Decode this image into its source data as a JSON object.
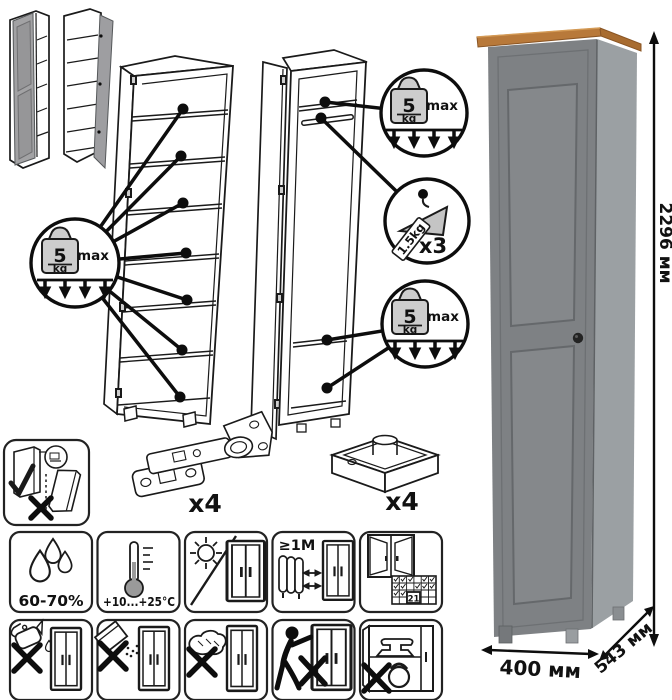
{
  "dimensions": {
    "height": "2296 мм",
    "width": "400 мм",
    "depth": "543 мм"
  },
  "load_limits": {
    "shelf": {
      "value": "5",
      "unit": "kg",
      "qualifier": "max"
    },
    "hanger": {
      "value": "1.5kg",
      "count": "x3"
    }
  },
  "hardware": {
    "hinge": {
      "count": "x4"
    },
    "foot": {
      "count": "x4"
    }
  },
  "care": {
    "humidity": "60-70%",
    "temperature": "+10...+25°C",
    "heater_distance": "≥1М",
    "ventilation_calendar_day": "21"
  },
  "colors": {
    "cabinet_front": "#7e8184",
    "cabinet_side": "#9ba0a3",
    "top_wood": "#b8793a",
    "line_art": "#1a1a1a"
  },
  "icons": {
    "shelf_load": "weight-5kg-icon",
    "hanger_load": "clothes-hanger-icon",
    "humidity": "water-drops-icon",
    "temperature": "thermometer-icon",
    "sunlight": "no-direct-sunlight-icon",
    "heater": "radiator-distance-icon",
    "ventilation": "window-ventilation-calendar-icon",
    "liquids": "no-liquid-cleaners-icon",
    "powder": "no-abrasive-powder-icon",
    "scouring": "no-scouring-pad-icon",
    "dragging": "no-dragging-icon",
    "overload": "no-heavy-items-icon",
    "anchoring": "wall-anchor-icon"
  }
}
